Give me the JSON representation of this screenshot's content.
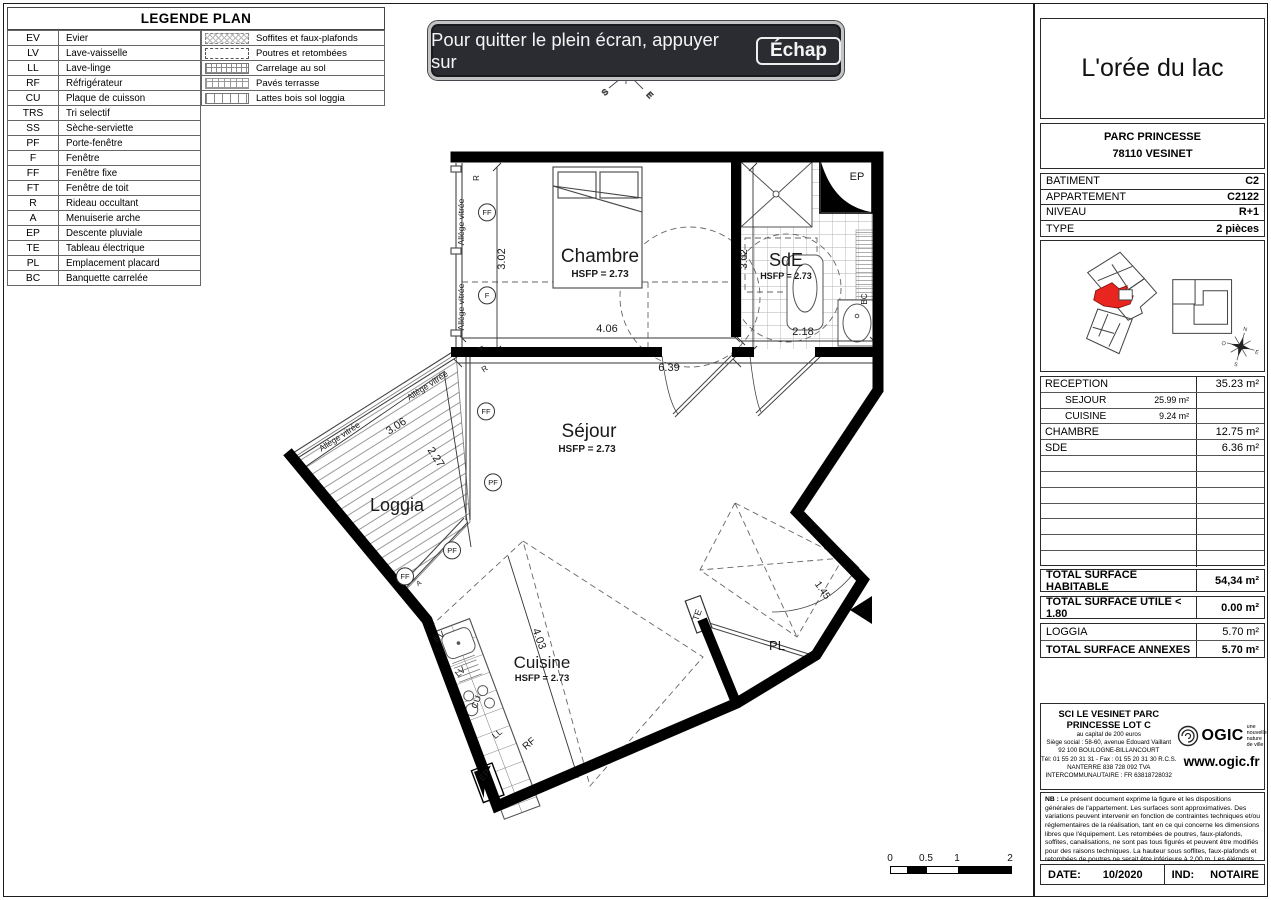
{
  "banner": {
    "text": "Pour quitter le plein écran, appuyer sur",
    "key": "Échap"
  },
  "legend": {
    "title": "LEGENDE PLAN",
    "abbreviations": [
      {
        "abbr": "EV",
        "label": "Evier"
      },
      {
        "abbr": "LV",
        "label": "Lave-vaisselle"
      },
      {
        "abbr": "LL",
        "label": "Lave-linge"
      },
      {
        "abbr": "RF",
        "label": "Réfrigérateur"
      },
      {
        "abbr": "CU",
        "label": "Plaque de cuisson"
      },
      {
        "abbr": "TRS",
        "label": "Tri selectif"
      },
      {
        "abbr": "SS",
        "label": "Sèche-serviette"
      },
      {
        "abbr": "PF",
        "label": "Porte-fenêtre"
      },
      {
        "abbr": "F",
        "label": "Fenêtre"
      },
      {
        "abbr": "FF",
        "label": "Fenêtre fixe"
      },
      {
        "abbr": "FT",
        "label": "Fenêtre de toit"
      },
      {
        "abbr": "R",
        "label": "Rideau occultant"
      },
      {
        "abbr": "A",
        "label": "Menuiserie arche"
      },
      {
        "abbr": "EP",
        "label": "Descente pluviale"
      },
      {
        "abbr": "TE",
        "label": "Tableau électrique"
      },
      {
        "abbr": "PL",
        "label": "Emplacement placard"
      },
      {
        "abbr": "BC",
        "label": "Banquette carrelée"
      }
    ],
    "patterns": [
      {
        "pattern": "soffites",
        "label": "Soffites et faux-plafonds"
      },
      {
        "pattern": "poutres",
        "label": "Poutres et retombées"
      },
      {
        "pattern": "carrelage",
        "label": "Carrelage au sol"
      },
      {
        "pattern": "paves",
        "label": "Pavés terrasse"
      },
      {
        "pattern": "lattes",
        "label": "Lattes bois sol loggia"
      }
    ]
  },
  "plan": {
    "compass": [
      "S",
      "E"
    ],
    "labels": [
      {
        "t": "Chambre",
        "x": 600,
        "y": 262,
        "s": 19
      },
      {
        "t": "HSFP = 2.73",
        "x": 600,
        "y": 277,
        "s": 10,
        "w": 700
      },
      {
        "t": "SdE",
        "x": 786,
        "y": 266,
        "s": 18
      },
      {
        "t": "HSFP = 2.73",
        "x": 786,
        "y": 279,
        "s": 9,
        "w": 700
      },
      {
        "t": "Séjour",
        "x": 589,
        "y": 437,
        "s": 19
      },
      {
        "t": "HSFP = 2.73",
        "x": 587,
        "y": 452,
        "s": 10,
        "w": 700
      },
      {
        "t": "Loggia",
        "x": 397,
        "y": 511,
        "s": 18
      },
      {
        "t": "Cuisine",
        "x": 542,
        "y": 668,
        "s": 17
      },
      {
        "t": "HSFP = 2.73",
        "x": 542,
        "y": 681,
        "s": 9.5,
        "w": 700
      },
      {
        "t": "PL",
        "x": 777,
        "y": 650,
        "s": 13
      },
      {
        "t": "TE",
        "x": 700,
        "y": 616,
        "s": 9,
        "r": -70
      },
      {
        "t": "EP",
        "x": 857,
        "y": 180,
        "s": 11
      },
      {
        "t": "EP",
        "x": 487,
        "y": 777,
        "s": 9,
        "r": -47
      },
      {
        "t": "BC",
        "x": 867,
        "y": 299,
        "s": 8,
        "r": -90
      },
      {
        "t": "RF",
        "x": 531,
        "y": 746,
        "s": 10,
        "r": -40
      },
      {
        "t": "LL",
        "x": 499,
        "y": 736,
        "s": 9,
        "r": -40
      },
      {
        "t": "CU",
        "x": 479,
        "y": 703,
        "s": 9,
        "r": -70
      },
      {
        "t": "LV",
        "x": 462,
        "y": 674,
        "s": 9,
        "r": -40
      },
      {
        "t": "EV",
        "x": 441,
        "y": 639,
        "s": 9,
        "r": -40
      },
      {
        "t": "3.02",
        "x": 505,
        "y": 259,
        "s": 11,
        "r": -90
      },
      {
        "t": "4.06",
        "x": 607,
        "y": 332,
        "s": 11
      },
      {
        "t": "6.39",
        "x": 669,
        "y": 371,
        "s": 11
      },
      {
        "t": "3.02",
        "x": 747,
        "y": 259,
        "s": 10,
        "r": -90
      },
      {
        "t": "2.18",
        "x": 803,
        "y": 335,
        "s": 11
      },
      {
        "t": "3.06",
        "x": 398,
        "y": 429,
        "s": 11,
        "r": -33
      },
      {
        "t": "2.27",
        "x": 433,
        "y": 459,
        "s": 11,
        "r": 57
      },
      {
        "t": "4.03",
        "x": 536,
        "y": 640,
        "s": 11,
        "r": 70
      },
      {
        "t": "1.45",
        "x": 820,
        "y": 592,
        "s": 10,
        "r": 55
      },
      {
        "t": "Allège vitrée",
        "x": 464,
        "y": 222,
        "s": 8.5,
        "r": -90
      },
      {
        "t": "Allège vitrée",
        "x": 464,
        "y": 307,
        "s": 8.5,
        "r": -90
      },
      {
        "t": "Allège vitrée",
        "x": 429,
        "y": 388,
        "s": 8.5,
        "r": -33
      },
      {
        "t": "Allège vitrée",
        "x": 341,
        "y": 439,
        "s": 8.5,
        "r": -33
      },
      {
        "t": "R",
        "x": 479,
        "y": 178,
        "s": 8,
        "r": -90
      },
      {
        "t": "R",
        "x": 486,
        "y": 371,
        "s": 8,
        "r": -33
      },
      {
        "t": "A",
        "x": 483,
        "y": 348,
        "s": 7,
        "r": -90
      },
      {
        "t": "A",
        "x": 420,
        "y": 585,
        "s": 7,
        "r": -33
      },
      {
        "t": "FF",
        "x": 487,
        "y": 215,
        "s": 7.5,
        "c": 1
      },
      {
        "t": "F",
        "x": 487,
        "y": 298,
        "s": 7.5,
        "c": 1
      },
      {
        "t": "FF",
        "x": 486,
        "y": 414,
        "s": 7.5,
        "c": 1
      },
      {
        "t": "PF",
        "x": 493,
        "y": 485,
        "s": 7.5,
        "c": 1
      },
      {
        "t": "PF",
        "x": 452,
        "y": 553,
        "s": 7.5,
        "c": 1
      },
      {
        "t": "FF",
        "x": 405,
        "y": 579,
        "s": 7.5,
        "c": 1
      }
    ]
  },
  "panel": {
    "title": "L'orée du lac",
    "address_line1": "PARC PRINCESSE",
    "address_line2": "78110 VESINET",
    "info_rows": [
      {
        "label": "BATIMENT",
        "value": "C2"
      },
      {
        "label": "APPARTEMENT",
        "value": "C2122"
      },
      {
        "label": "NIVEAU",
        "value": "R+1"
      },
      {
        "label": "TYPE",
        "value": "2 pièces"
      }
    ],
    "keyplan": {
      "compass": [
        "N",
        "E",
        "S",
        "O"
      ]
    },
    "surface_rows": [
      {
        "label": "RECEPTION",
        "value": "35.23 m²",
        "style": "main"
      },
      {
        "label": "SEJOUR",
        "value": "25.99 m²",
        "style": "sub"
      },
      {
        "label": "CUISINE",
        "value": "9.24 m²",
        "style": "sub"
      },
      {
        "label": "CHAMBRE",
        "value": "12.75 m²",
        "style": "main"
      },
      {
        "label": "SDE",
        "value": "6.36 m²",
        "style": "main"
      },
      {
        "label": "",
        "value": "",
        "style": "empty"
      },
      {
        "label": "",
        "value": "",
        "style": "empty"
      },
      {
        "label": "",
        "value": "",
        "style": "empty"
      },
      {
        "label": "",
        "value": "",
        "style": "empty"
      },
      {
        "label": "",
        "value": "",
        "style": "empty"
      },
      {
        "label": "",
        "value": "",
        "style": "empty"
      },
      {
        "label": "",
        "value": "",
        "style": "empty"
      }
    ],
    "total_habitable": {
      "label": "TOTAL SURFACE HABITABLE",
      "value": "54,34 m²"
    },
    "total_utile": {
      "label": "TOTAL SURFACE UTILE < 1.80",
      "value": "0.00 m²"
    },
    "annex_rows": [
      {
        "label": "LOGGIA",
        "value": "5.70 m²",
        "bold": false
      },
      {
        "label": "TOTAL SURFACE ANNEXES",
        "value": "5.70 m²",
        "bold": true
      }
    ],
    "ogic": {
      "company_line1": "SCI LE VESINET PARC",
      "company_line2": "PRINCESSE LOT C",
      "details": [
        "au capital de 200 euros",
        "Siège social : 58-60, avenue Edouard Vaillant",
        "92 100 BOULOGNE-BILLANCOURT",
        "Tél: 01 55 20 31 31 - Fax : 01 55 20 31 30 R.C.S.",
        "NANTERRE 838 728 092    TVA",
        "INTERCOMMUNAUTAIRE : FR 63818728032"
      ],
      "logo": "OGIC",
      "tagline_lines": [
        "une",
        "nouvelle",
        "nature",
        "de ville"
      ],
      "website": "www.ogic.fr"
    },
    "nb_label": "NB :",
    "nb_text": " Le présent document exprime la figure et les dispositions générales de l'appartement. Les surfaces sont approximatives. Des variations peuvent intervenir en fonction de contraintes techniques et/ou réglementaires de la réalisation, tant en ce qui concerne les dimensions libres que l'équipement. Les retombées de poutres, faux-plafonds, soffites, canalisations, ne sont pas tous figurés et peuvent être modifiés pour des raisons techniques. La hauteur sous soffites, faux-plafonds et retombées de poutres ne serait être inférieure à 2,00 m. Les éléments de mobiliers de cuisine et les implantations des équipements électriques sont présentés à titre indicatif.",
    "date_label": "DATE:",
    "date_value": "10/2020",
    "ind_label": "IND:",
    "ind_value": "NOTAIRE"
  },
  "scalebar": {
    "labels": [
      "0",
      "0.5",
      "1",
      "2"
    ]
  }
}
